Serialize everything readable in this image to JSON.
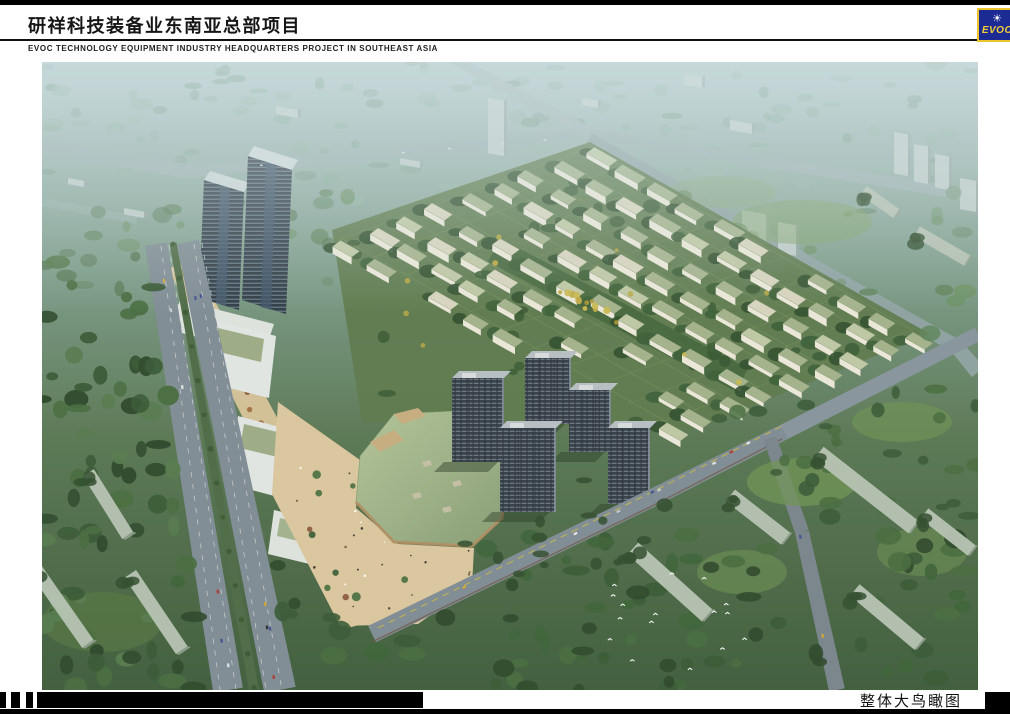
{
  "header": {
    "title": "研祥科技装备业东南亚总部项目",
    "subtitle": "EVOC TECHNOLOGY EQUIPMENT INDUSTRY HEADQUARTERS PROJECT IN SOUTHEAST ASIA"
  },
  "logo": {
    "text": "EVOC",
    "sun_icon": "☀",
    "blue": "#1c2b93",
    "yellow": "#edc62e"
  },
  "footer": {
    "caption": "整体大鸟瞰图"
  },
  "colors": {
    "sky_haze": "#b0c5c6",
    "distant_green": "#7e9c8a",
    "foliage_dark": "#2e4a29",
    "foliage_mid": "#46683c",
    "lawn_green": "#6d9150",
    "road_gray": "#7f8b92",
    "distant_road": "#9cb0af",
    "roof_green": "#a4b28a",
    "roof_cream": "#d8d4bd",
    "wall_cream": "#ece8d9",
    "plaza_tan": "#d9c498",
    "mall_roof": "#a6ba8c",
    "tower_dark": "#2c3842",
    "residential_dark": "#343d46",
    "slab_pale": "#b6c1b0",
    "office_white": "#e2e6e2",
    "median_green": "#4c6842",
    "lane_yellow": "#c9b93f"
  }
}
